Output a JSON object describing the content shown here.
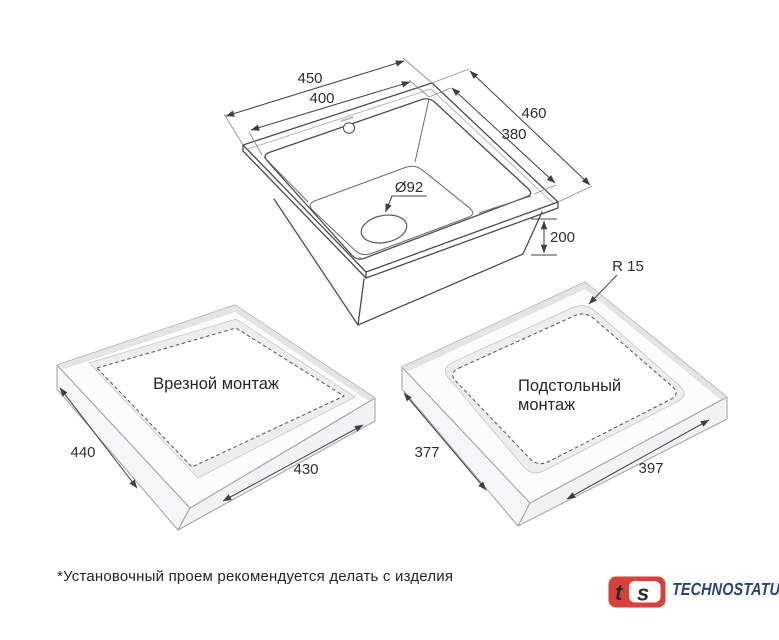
{
  "sink_view": {
    "outer_width": "450",
    "inner_width": "400",
    "outer_depth": "460",
    "inner_depth": "380",
    "drain_diameter": "Ø92",
    "bowl_depth": "200"
  },
  "drop_in_mount": {
    "label": "Врезной монтаж",
    "cutout_width": "440",
    "cutout_length": "430"
  },
  "under_mount": {
    "label_line1": "Подстольный",
    "label_line2": "монтаж",
    "corner_radius": "R 15",
    "cutout_width": "377",
    "cutout_length": "397"
  },
  "footnote": "*Установочный проем рекомендуется делать с изделия",
  "brand": {
    "monogram_t": "t",
    "monogram_s": "s",
    "name": "TECHNOSTATUS",
    "red": "#D9423A",
    "blue": "#2A4377"
  }
}
